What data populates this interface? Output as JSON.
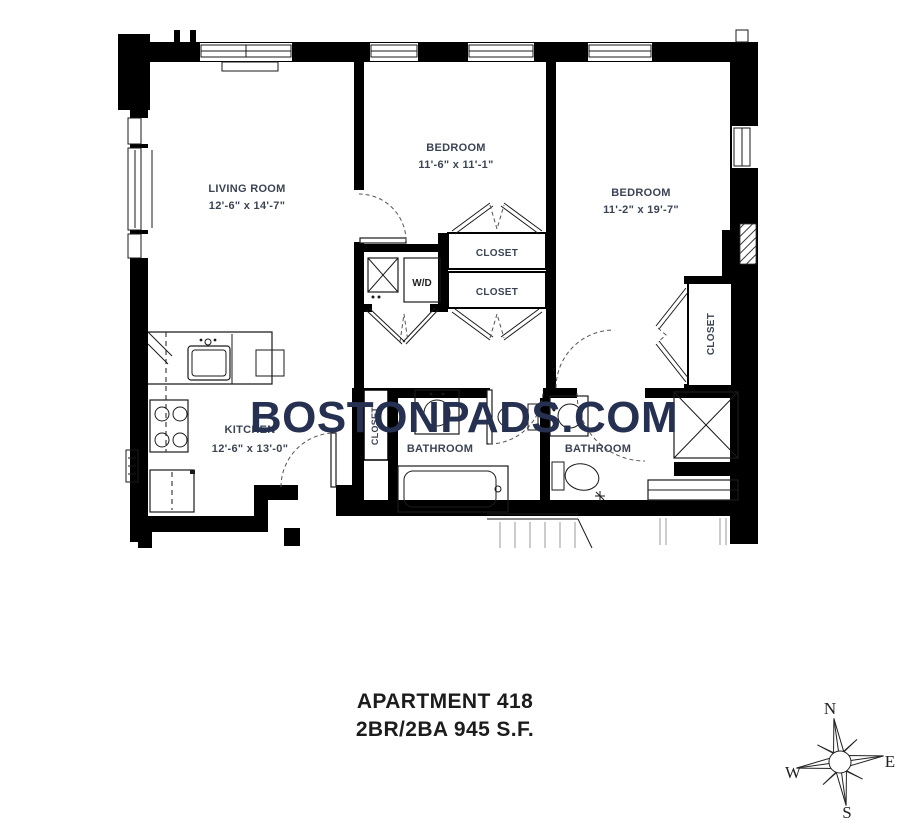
{
  "watermark": "BOSTONPADS.COM",
  "title": {
    "line1": "APARTMENT 418",
    "line2": "2BR/2BA 945 S.F."
  },
  "rooms": {
    "living_room": {
      "name": "LIVING ROOM",
      "dims": "12'-6\" x 14'-7\""
    },
    "bedroom_1": {
      "name": "BEDROOM",
      "dims": "11'-6\" x 11'-1\""
    },
    "bedroom_2": {
      "name": "BEDROOM",
      "dims": "11'-2\" x 19'-7\""
    },
    "kitchen": {
      "name": "KITCHEN",
      "dims": "12'-6\" x 13'-0\""
    },
    "bathroom_1": {
      "name": "BATHROOM"
    },
    "bathroom_2": {
      "name": "BATHROOM"
    },
    "closet_upper": {
      "name": "CLOSET"
    },
    "closet_lower": {
      "name": "CLOSET"
    },
    "closet_bedroom_2": {
      "name": "CLOSET"
    },
    "closet_entry": {
      "name": "CLOSET"
    },
    "laundry": {
      "name": "W/D"
    }
  },
  "compass": {
    "north": "N",
    "east": "E",
    "south": "S",
    "west": "W"
  },
  "colors": {
    "walls": "#000000",
    "watermark": "#263050",
    "room_label": "#3c4454",
    "title": "#1c1c1c"
  }
}
